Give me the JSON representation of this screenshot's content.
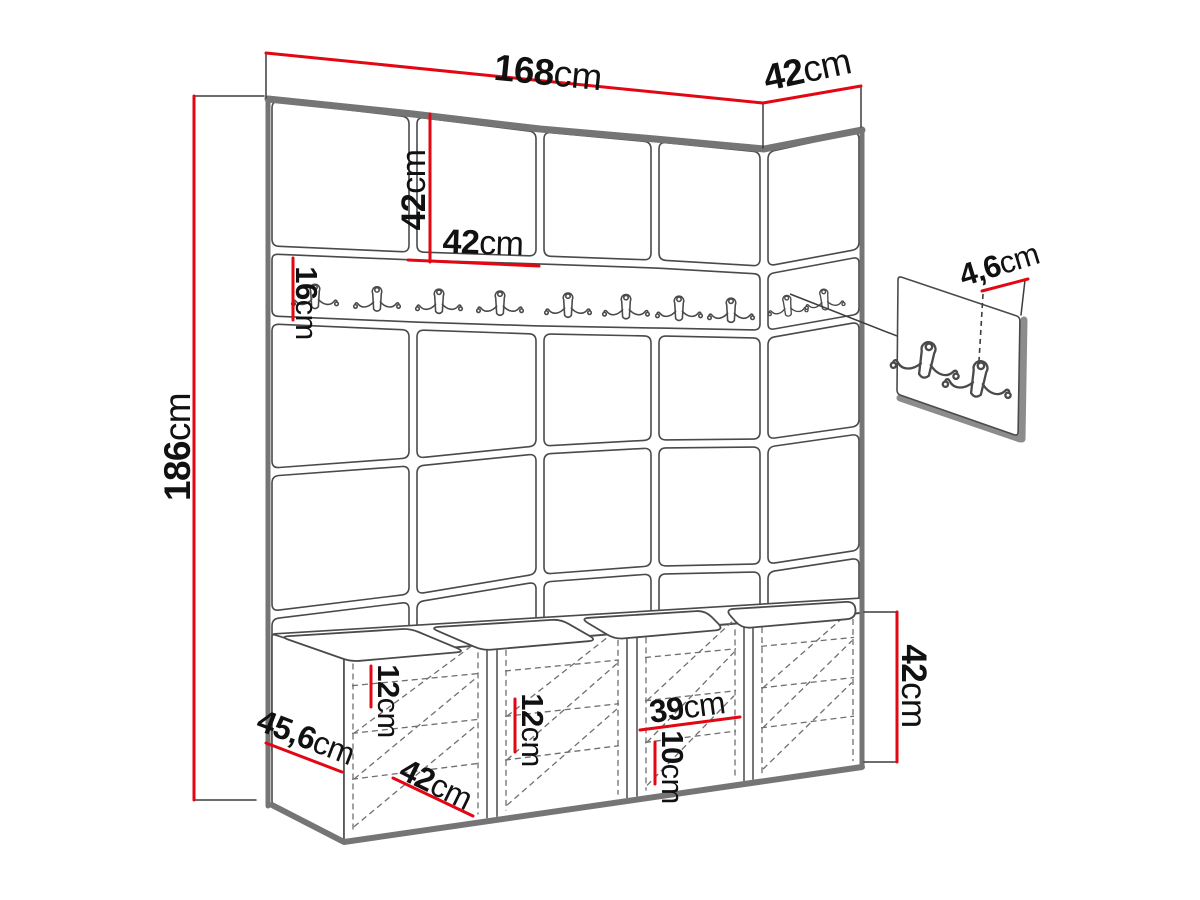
{
  "diagram": {
    "type": "furniture-dimension-diagram",
    "subject": "hallway wall panel set with coat hook rail, hook detail panel and shoe storage bench",
    "colors": {
      "dimension_red": "#e30613",
      "outline": "#4a4a4a",
      "edge_band": "#757575",
      "background": "#ffffff"
    },
    "dimensions": [
      {
        "id": "total-width",
        "value": "168",
        "unit": "cm"
      },
      {
        "id": "side-depth",
        "value": "42",
        "unit": "cm"
      },
      {
        "id": "total-height",
        "value": "186",
        "unit": "cm"
      },
      {
        "id": "panel-height",
        "value": "42",
        "unit": "cm"
      },
      {
        "id": "panel-width",
        "value": "42",
        "unit": "cm"
      },
      {
        "id": "rail-height",
        "value": "16",
        "unit": "cm"
      },
      {
        "id": "hook-panel-thickness",
        "value": "4,6",
        "unit": "cm"
      },
      {
        "id": "bench-shelf-gap-left",
        "value": "12",
        "unit": "cm"
      },
      {
        "id": "bench-shelf-gap-mid",
        "value": "12",
        "unit": "cm"
      },
      {
        "id": "bench-compartment-width",
        "value": "39",
        "unit": "cm"
      },
      {
        "id": "bench-shelf-gap-low",
        "value": "10",
        "unit": "cm"
      },
      {
        "id": "bench-height",
        "value": "42",
        "unit": "cm"
      },
      {
        "id": "bench-depth",
        "value": "45,6",
        "unit": "cm"
      },
      {
        "id": "bench-door-width",
        "value": "42",
        "unit": "cm"
      }
    ],
    "hooks": {
      "rail_double_hooks": 8,
      "side_rail_double_hooks": 2,
      "detail_panel_hooks": 2
    },
    "structure": {
      "front_panel_columns": 4,
      "side_panel_columns": 1,
      "panel_rows": 4,
      "bench_compartments": 4,
      "bench_cushions": 4
    }
  }
}
